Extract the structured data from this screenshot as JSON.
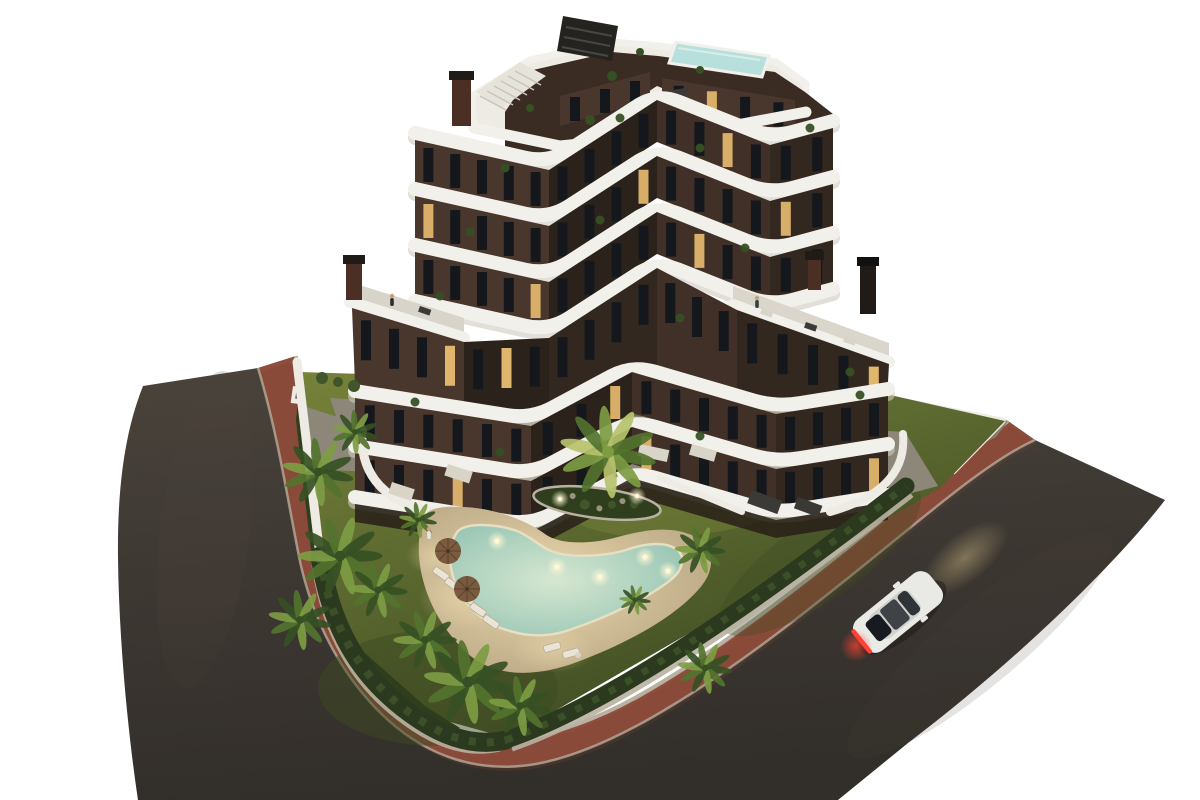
{
  "scene": {
    "title": "Aerial dusk render of a modern apartment complex",
    "description": "Seven-storey apartment building with curved white balcony bands and dark brown facade, rooftop plunge pool, pergola and stair, garden with freeform lit swimming pool on a sand deck, sun loungers and parasols, palm trees, hedge borders, terracotta pedestrian path and L-shaped asphalt streets with one white car driving at dusk.",
    "background": "#ffffff",
    "time_of_day": "dusk"
  },
  "palette": {
    "bg": "#ffffff",
    "asphalt": "#3f3934",
    "asphalt_light": "#4b443c",
    "asphalt_dark": "#322e29",
    "path_red": "#8f4d3d",
    "path_red_dark": "#7a4234",
    "curb": "#b9b1a1",
    "verge": "#87806a",
    "grass_light": "#76823a",
    "grass": "#5d6a30",
    "grass_dark": "#3d4a22",
    "bed": "#2f3f1e",
    "hedge": "#2b391e",
    "hedge_light": "#40552a",
    "sand": "#cab893",
    "sand_lit": "#ecd9ad",
    "sand_dark": "#b3a07e",
    "pool_deep": "#8fbfae",
    "pool_mid": "#aed2bf",
    "pool_light": "#d6e7d0",
    "pool_lip": "#e7dfc3",
    "band_white": "#f2f0ea",
    "band_shade": "#cfcabf",
    "facade_a": "#49362c",
    "facade_b": "#2c221c",
    "facade_c": "#413027",
    "facade_d": "#33281f",
    "window": "#14181d",
    "window_lit": "#e0b56c",
    "roof_deck": "#eeebe4",
    "roof_pool": "#b7e0dc",
    "pergola": "#25231f",
    "terrace": "#8c8779",
    "wall_white": "#edebe3",
    "chimney": "#4b2f24",
    "chimney_dark": "#201b17",
    "palm_dark": "#365024",
    "palm_mid": "#52732e",
    "palm_light": "#7d9c43",
    "palm_lit": "#b6c36b",
    "trunk": "#6d5b41",
    "furn_light": "#d9d4c8",
    "furn_dark": "#3b3a36",
    "car_body": "#e9e9e6",
    "car_roof": "#d0d0cc",
    "car_glass": "#171a20",
    "taillight": "#ff4234",
    "beam": "#d9c289",
    "shadow": "#1d1a16",
    "light_dot": "#fff7d6"
  },
  "building": {
    "floors": 7,
    "tower_floors": 4,
    "podium_floors": 3,
    "balcony_style": "curved white bands",
    "facade_color_name": "dark brown",
    "rooftop_features": [
      "plunge pool",
      "pergola",
      "staircase",
      "planters"
    ],
    "chimneys": 4,
    "lit_windows": true
  },
  "garden": {
    "pool": {
      "shape": "freeform heart lagoon",
      "underwater_lights": 5,
      "deck": "sand beach"
    },
    "island_planter": {
      "lights": 2
    },
    "palm_trees": 13,
    "sun_loungers": 7,
    "parasols": 2,
    "hedge_border": true
  },
  "streets": {
    "left_road_surface": "asphalt",
    "right_road_surface": "asphalt",
    "path_color_name": "terracotta red",
    "curbs": "light stone"
  },
  "vehicles": [
    {
      "type": "sedan",
      "color_name": "white",
      "headlights_on": true,
      "taillights_on": true
    }
  ],
  "people_visible": 3
}
